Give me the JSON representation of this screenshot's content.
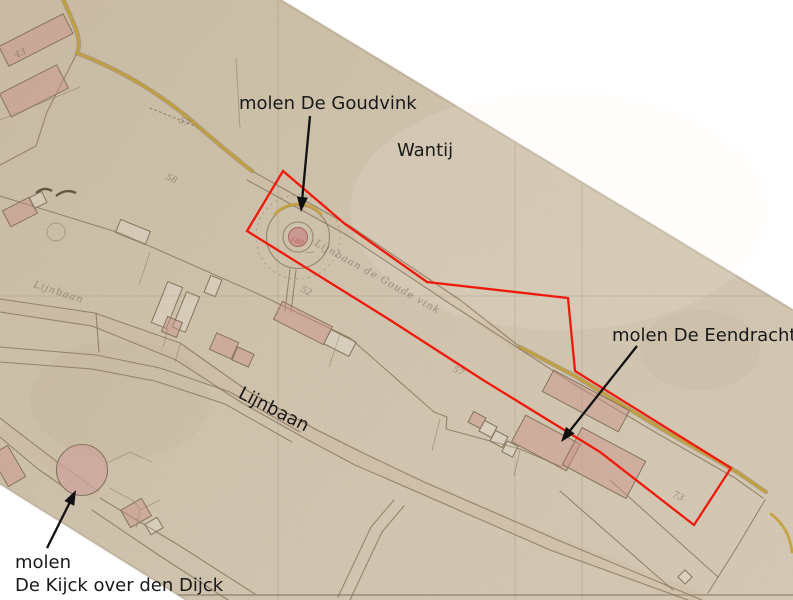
{
  "annotations": {
    "goudvink": {
      "text": "molen De Goudvink"
    },
    "wantij": {
      "text": "Wantij"
    },
    "eendracht": {
      "text": "molen De Eendracht"
    },
    "lijnbaan": {
      "text": "Lijnbaan"
    },
    "kijck": {
      "line1": "molen",
      "line2": "De Kijck over den Dijck"
    }
  },
  "arrows": [
    {
      "name": "goudvink-arrow",
      "from": [
        310,
        116
      ],
      "to": [
        301,
        212
      ]
    },
    {
      "name": "eendracht-arrow",
      "from": [
        637,
        346
      ],
      "to": [
        561,
        442
      ]
    },
    {
      "name": "kijck-arrow",
      "from": [
        47,
        548
      ],
      "to": [
        76,
        490
      ]
    }
  ],
  "map_inscriptions": [
    {
      "text": "Lijnbaan de Goude vink",
      "x": 314,
      "y": 245,
      "rot": 29,
      "cls": "hand"
    },
    {
      "text": "Lijnbaan",
      "x": 33,
      "y": 287,
      "rot": 18,
      "cls": "hand"
    },
    {
      "text": "43",
      "x": 16,
      "y": 58,
      "rot": -22,
      "cls": "num"
    },
    {
      "text": "57",
      "x": 178,
      "y": 122,
      "rot": 25,
      "cls": "num"
    },
    {
      "text": "58",
      "x": 165,
      "y": 179,
      "rot": 25,
      "cls": "num"
    },
    {
      "text": "52",
      "x": 300,
      "y": 291,
      "rot": 27,
      "cls": "num"
    },
    {
      "text": "57",
      "x": 452,
      "y": 371,
      "rot": 27,
      "cls": "num"
    },
    {
      "text": "73",
      "x": 672,
      "y": 496,
      "rot": 27,
      "cls": "num"
    },
    {
      "text": "180",
      "x": 290,
      "y": 241,
      "rot": 18,
      "cls": "num-red"
    }
  ],
  "mills": [
    {
      "name": "De Goudvink",
      "cx": 298,
      "cy": 237
    },
    {
      "name": "De Eendracht",
      "cx": 560,
      "cy": 440
    },
    {
      "name": "De Kijck over den Dijck",
      "cx": 82,
      "cy": 470
    }
  ],
  "colors": {
    "background": "#ffffff",
    "paper": "#cfc3ae",
    "line": "#85745c",
    "yellow_road": "#c2a038",
    "red_outline": "#ef1a0c",
    "building_pink": "#c99087",
    "annotation_ink": "#191919",
    "handwriting": "#6f6150"
  }
}
